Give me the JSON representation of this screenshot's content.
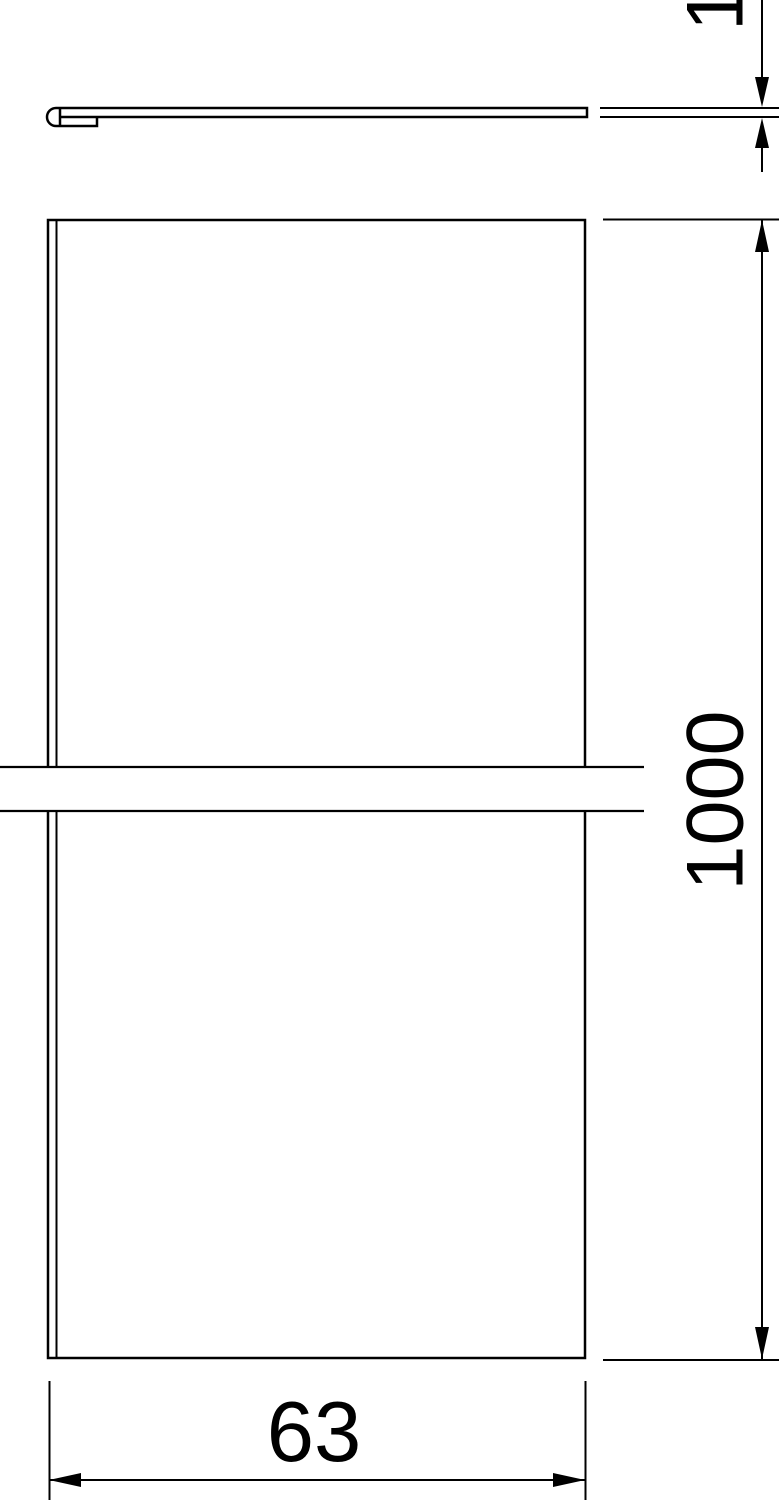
{
  "colors": {
    "line": "#000000",
    "background": "#ffffff"
  },
  "dimensions": {
    "thickness_label": "1",
    "length_label": "1000",
    "width_label": "63"
  }
}
